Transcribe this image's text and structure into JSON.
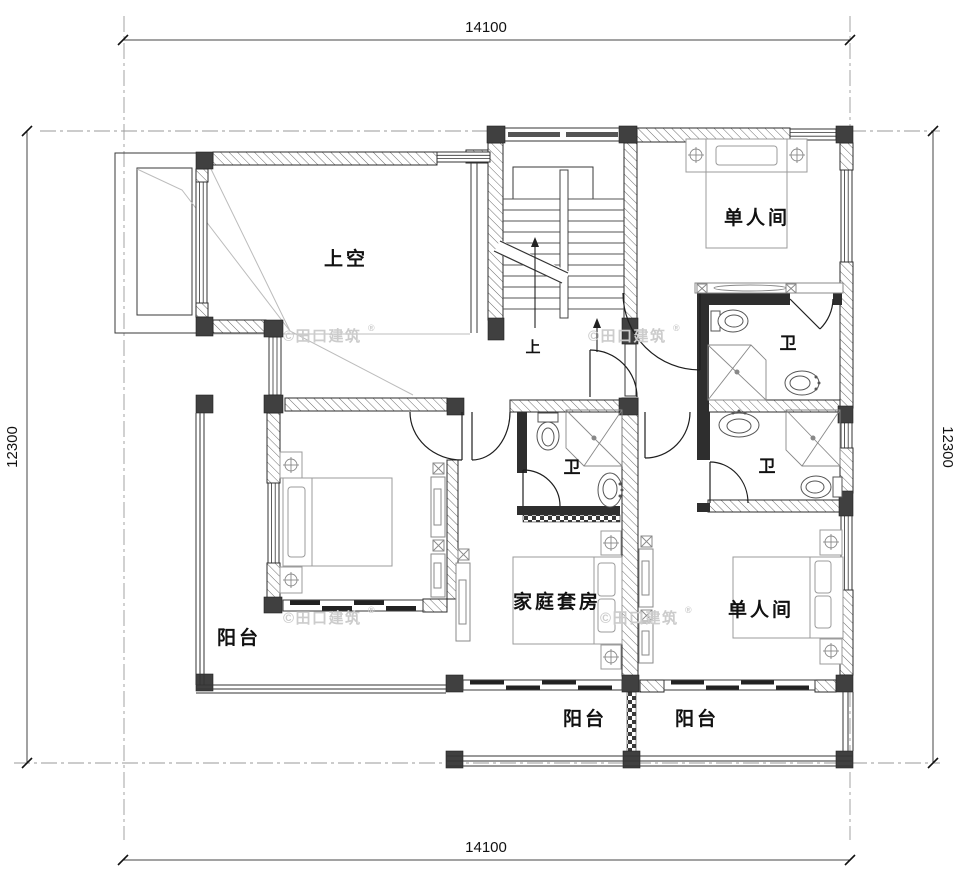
{
  "dimensions": {
    "top": "14100",
    "bottom": "14100",
    "left": "12300",
    "right": "12300"
  },
  "rooms": {
    "void": {
      "label": "上空"
    },
    "bedroom_top_right": {
      "label": "单人间"
    },
    "bath_top_right": {
      "label": "卫"
    },
    "bath_middle": {
      "label": "卫"
    },
    "bath_right": {
      "label": "卫"
    },
    "family_suite": {
      "label": "家庭套房"
    },
    "bedroom_bottom_right": {
      "label": "单人间"
    },
    "balcony_left": {
      "label": "阳台"
    },
    "balcony_middle": {
      "label": "阳台"
    },
    "balcony_right": {
      "label": "阳台"
    }
  },
  "stairs": {
    "direction_label": "上"
  },
  "watermark": {
    "text": "©田口建筑",
    "registered_mark": "®"
  },
  "colors": {
    "line": "#2b2b2b",
    "column_fill": "#404040",
    "watermark": "#cccccc",
    "background": "#ffffff"
  }
}
